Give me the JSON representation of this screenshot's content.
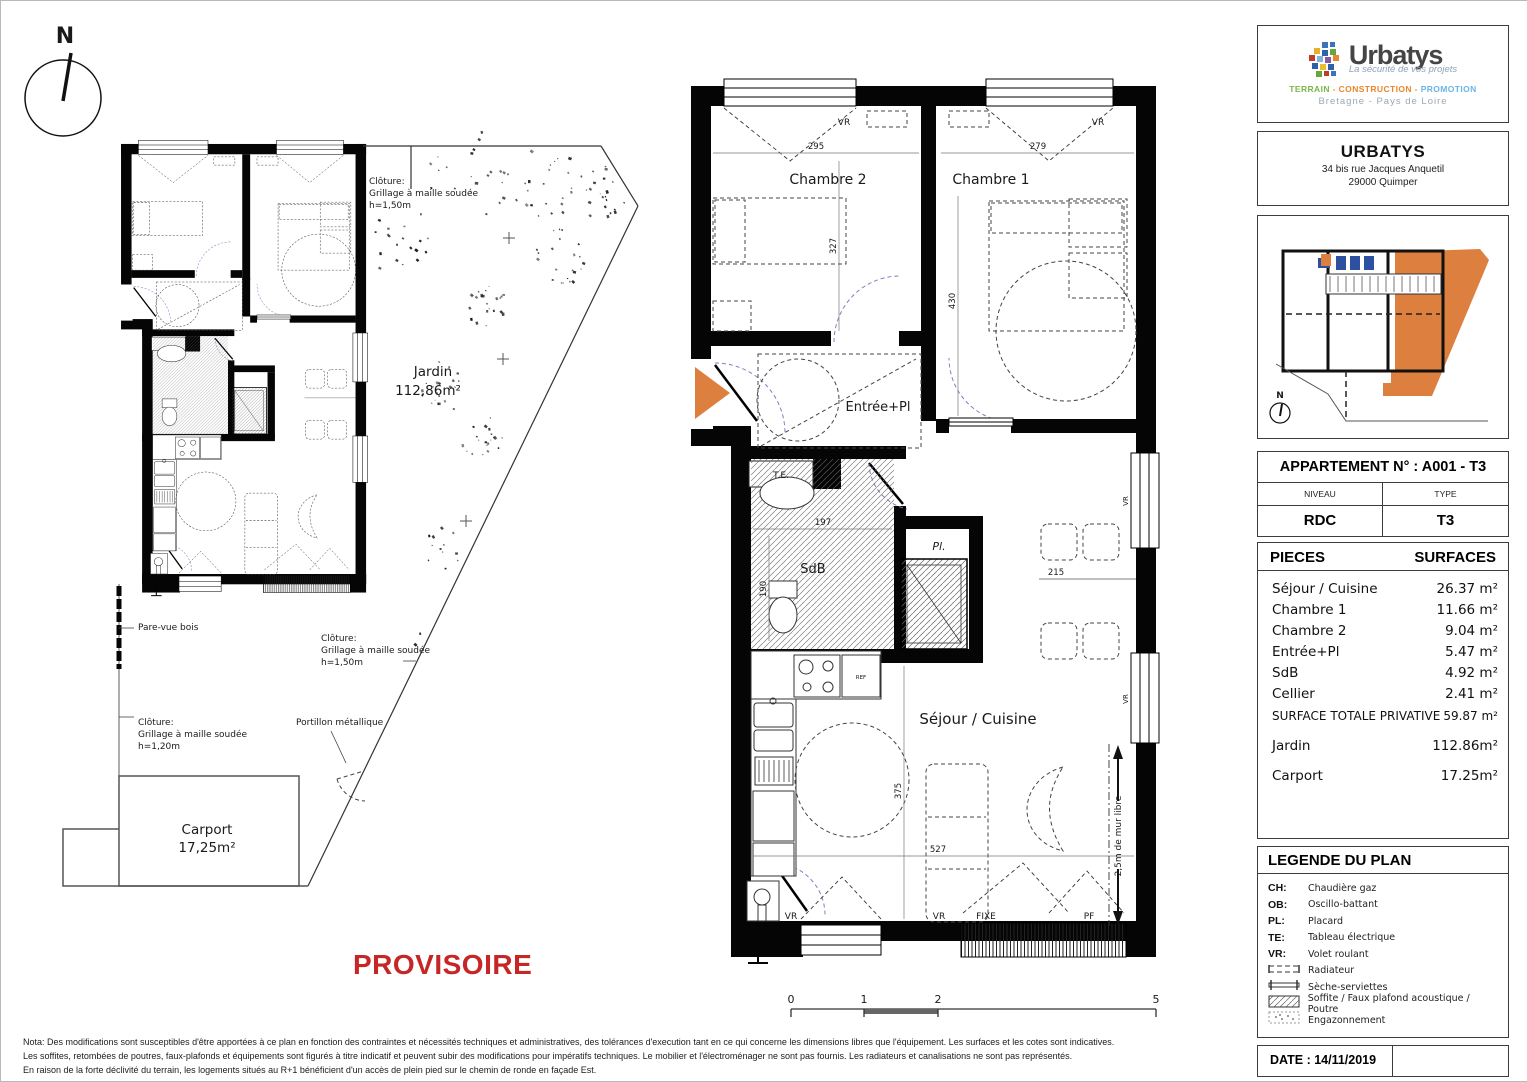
{
  "page": {
    "provisoire": "PROVISOIRE",
    "notes": [
      "Nota: Des modifications sont susceptibles d'être apportées à ce plan en fonction des contraintes et nécessités techniques et administratives, des tolérances d'execution tant en ce qui concerne les dimensions libres que l'équipement. Les surfaces et les cotes sont indicatives.",
      "Les soffites, retombées de poutres, faux-plafonds et équipements sont figurés à titre indicatif et peuvent subir des modifications pour impératifs techniques. Le mobilier et l'électroménager ne sont pas fournis. Les radiateurs et canalisations ne sont pas représentés.",
      "En raison de la forte déclivité du terrain, les logements situés au R+1 bénéficient d'un accès de plein pied sur le chemin de ronde en façade Est."
    ],
    "scale": {
      "t0": "0",
      "t1": "1",
      "t2": "2",
      "t5": "5"
    }
  },
  "site": {
    "north": "N",
    "jardin_name": "Jardin",
    "jardin_area": "112,86m²",
    "carport_name": "Carport",
    "carport_area": "17,25m²",
    "fence_top": [
      "Clôture:",
      "Grillage à maille soudée",
      "h=1,50m"
    ],
    "fence_left": [
      "Clôture:",
      "Grillage à maille soudée",
      "h=1,20m"
    ],
    "fence_right": [
      "Clôture:",
      "Grillage à maille soudée",
      "h=1,50m"
    ],
    "pare_vue": "Pare-vue bois",
    "portillon": "Portillon métallique"
  },
  "plan": {
    "north": "N",
    "rooms": {
      "chambre2": "Chambre 2",
      "chambre1": "Chambre 1",
      "entree": "Entrée+Pl",
      "te": "T.E.",
      "sdb": "SdB",
      "pl": "Pl.",
      "sejour": "Séjour / Cuisine"
    },
    "dims": {
      "d295": "295",
      "d279": "279",
      "d327": "327",
      "d430": "430",
      "d197": "197",
      "d190": "190",
      "d215": "215",
      "d375": "375",
      "d527": "527",
      "mur_libre": "2,5m de mur libre"
    },
    "tags": {
      "vr": "VR",
      "fixe": "FIXE",
      "pf": "PF",
      "ref": "REF"
    }
  },
  "sidebar": {
    "logo": {
      "name": "Urbatys",
      "tagline": "La sécurité de vos projets",
      "sector1": "TERRAIN",
      "sector2": "CONSTRUCTION",
      "sector3": "PROMOTION",
      "sector_sep": " - ",
      "regions": "Bretagne - Pays de Loire"
    },
    "address": {
      "name": "URBATYS",
      "line1": "34 bis rue Jacques Anquetil",
      "line2": "29000 Quimper"
    },
    "map": {
      "north": "N"
    },
    "apartment": {
      "title": "APPARTEMENT N° : A001 - T3",
      "col1_header": "NIVEAU",
      "col2_header": "TYPE",
      "col1_value": "RDC",
      "col2_value": "T3"
    },
    "surfaces": {
      "header_left": "PIECES",
      "header_right": "SURFACES",
      "rows": [
        {
          "label": "Séjour / Cuisine",
          "value": "26.37 m²"
        },
        {
          "label": "Chambre 1",
          "value": "11.66 m²"
        },
        {
          "label": "Chambre 2",
          "value": "9.04 m²"
        },
        {
          "label": "Entrée+Pl",
          "value": "5.47 m²"
        },
        {
          "label": "SdB",
          "value": "4.92 m²"
        },
        {
          "label": "Cellier",
          "value": "2.41 m²"
        },
        {
          "label": "SURFACE TOTALE PRIVATIVE",
          "value": "59.87 m²"
        }
      ],
      "outdoor_rows": [
        {
          "label": "Jardin",
          "value": "112.86m²"
        },
        {
          "label": "Carport",
          "value": "17.25m²"
        }
      ]
    },
    "legend": {
      "title": "LEGENDE DU PLAN",
      "abbr_items": [
        {
          "abbr": "CH:",
          "label": "Chaudière gaz"
        },
        {
          "abbr": "OB:",
          "label": "Oscillo-battant"
        },
        {
          "abbr": "PL:",
          "label": "Placard"
        },
        {
          "abbr": "TE:",
          "label": "Tableau électrique"
        },
        {
          "abbr": "VR:",
          "label": "Volet roulant"
        }
      ],
      "icon_items": [
        {
          "icon": "radiator-icon",
          "label": "Radiateur"
        },
        {
          "icon": "towel-rail-icon",
          "label": "Sèche-serviettes"
        },
        {
          "icon": "soffit-hatch-icon",
          "label": "Soffite / Faux plafond acoustique / Poutre"
        },
        {
          "icon": "grass-icon",
          "label": "Engazonnement"
        }
      ]
    },
    "date": "DATE : 14/11/2019"
  },
  "colors": {
    "accent_orange": "#dd7f3f",
    "provisoire_red": "#c62626",
    "door_arc_blue": "#8080c0"
  }
}
